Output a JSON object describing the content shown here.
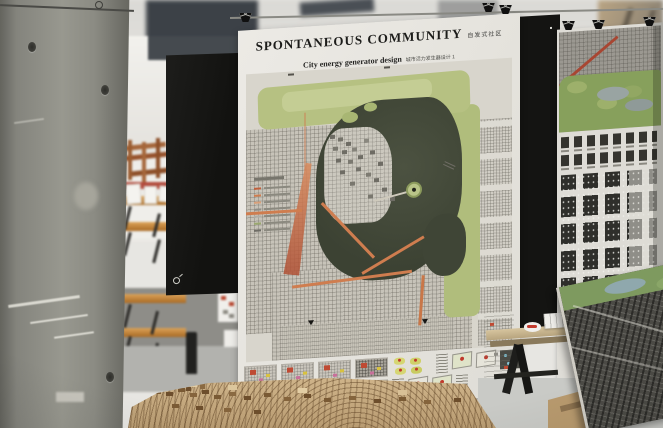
{
  "main_poster": {
    "title": "SPONTANEOUS COMMUNITY",
    "title_zh": "自发式社区",
    "subtitle": "City energy generator design",
    "subtitle_zh": "城市活力发生器设计 1"
  },
  "palette": {
    "paper_white": "#e9e7e2",
    "board_black": "#171715",
    "concrete_gray": "#8f8f89",
    "bench_wood": "#b5772f",
    "model_wood": "#c6ab80",
    "map_lake_dark": "#434a39",
    "map_park_green": "#b5c17f",
    "map_route_orange": "#cd7a4e",
    "map_fabric_gray": "#c8c4ba"
  },
  "icons": {
    "binder_clip": "css-shape",
    "logo_mark": "css-shape"
  }
}
